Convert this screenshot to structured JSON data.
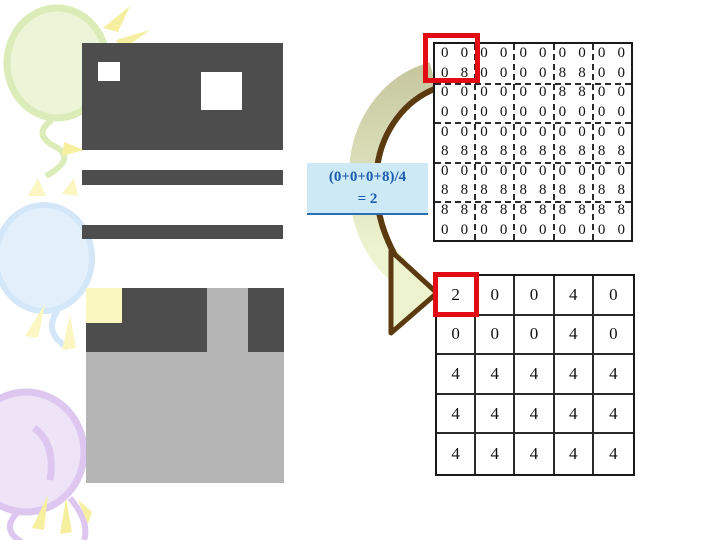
{
  "formula_box": {
    "line1": "(0+0+0+8)/4",
    "line2": "= 2",
    "text_color": "#1b5cad",
    "background_color": "#cde9f6"
  },
  "source_matrix": {
    "rows": [
      [
        "0",
        "0",
        "0",
        "0",
        "0",
        "0",
        "0",
        "0",
        "0",
        "0"
      ],
      [
        "0",
        "8",
        "0",
        "0",
        "0",
        "0",
        "8",
        "8",
        "0",
        "0"
      ],
      [
        "0",
        "0",
        "0",
        "0",
        "0",
        "0",
        "8",
        "8",
        "0",
        "0"
      ],
      [
        "0",
        "0",
        "0",
        "0",
        "0",
        "0",
        "0",
        "0",
        "0",
        "0"
      ],
      [
        "0",
        "0",
        "0",
        "0",
        "0",
        "0",
        "0",
        "0",
        "0",
        "0"
      ],
      [
        "8",
        "8",
        "8",
        "8",
        "8",
        "8",
        "8",
        "8",
        "8",
        "8"
      ],
      [
        "0",
        "0",
        "0",
        "0",
        "0",
        "0",
        "0",
        "0",
        "0",
        "0"
      ],
      [
        "8",
        "8",
        "8",
        "8",
        "8",
        "8",
        "8",
        "8",
        "8",
        "8"
      ],
      [
        "8",
        "8",
        "8",
        "8",
        "8",
        "8",
        "8",
        "8",
        "8",
        "8"
      ],
      [
        "0",
        "0",
        "0",
        "0",
        "0",
        "0",
        "0",
        "0",
        "0",
        "0"
      ]
    ],
    "highlighted_block": "rows 1-2, columns 1-2",
    "highlight_color": "#e30b13"
  },
  "result_matrix": {
    "rows": [
      [
        "2",
        "0",
        "0",
        "4",
        "0"
      ],
      [
        "0",
        "0",
        "0",
        "4",
        "0"
      ],
      [
        "4",
        "4",
        "4",
        "4",
        "4"
      ],
      [
        "4",
        "4",
        "4",
        "4",
        "4"
      ],
      [
        "4",
        "4",
        "4",
        "4",
        "4"
      ]
    ],
    "highlighted_cell": "row 1, column 1",
    "highlight_color": "#e30b13"
  },
  "colors": {
    "dark_shape": "#4d4d4d",
    "light_shape": "#b5b5b5",
    "pale_yellow_block": "#fbf7c0",
    "arrow_outline": "#5b3a10",
    "arrow_fill_top": "#c7c8a0",
    "arrow_fill_bottom": "#edf3cf",
    "balloon_green": "#ecf5d8",
    "balloon_blue": "#e3f0fb",
    "balloon_purple": "#efe3f8",
    "sparkle_yellow": "#f6ef9f"
  }
}
